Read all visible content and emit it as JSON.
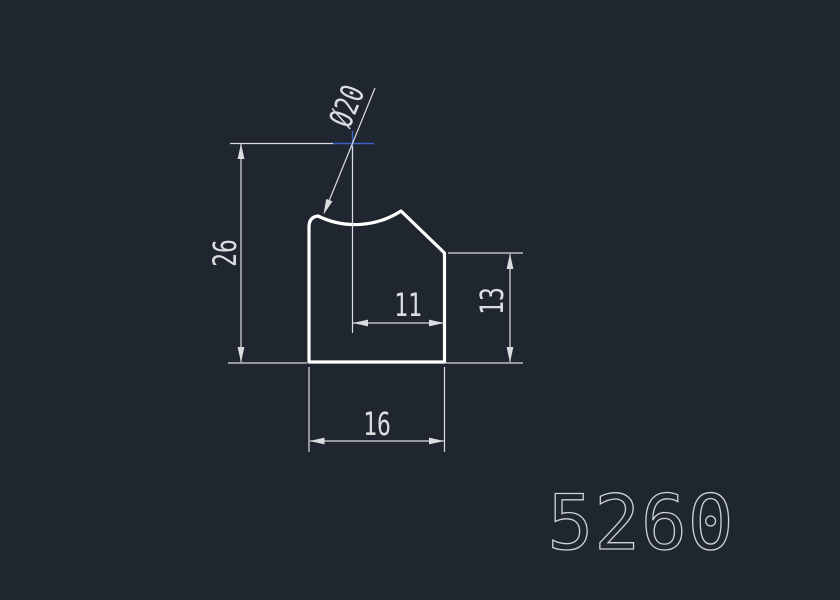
{
  "drawing": {
    "part_number": "5260",
    "labels": {
      "diameter": "Ø20",
      "overall_height": "26",
      "top_width": "11",
      "right_height": "13",
      "bottom_width": "16"
    },
    "colors": {
      "background": "#20262f",
      "profile_outline": "#ffffff",
      "dimension_lines": "#dadcdf",
      "center_mark": "#3a62c4",
      "part_number_text": "#cdd2da"
    }
  }
}
